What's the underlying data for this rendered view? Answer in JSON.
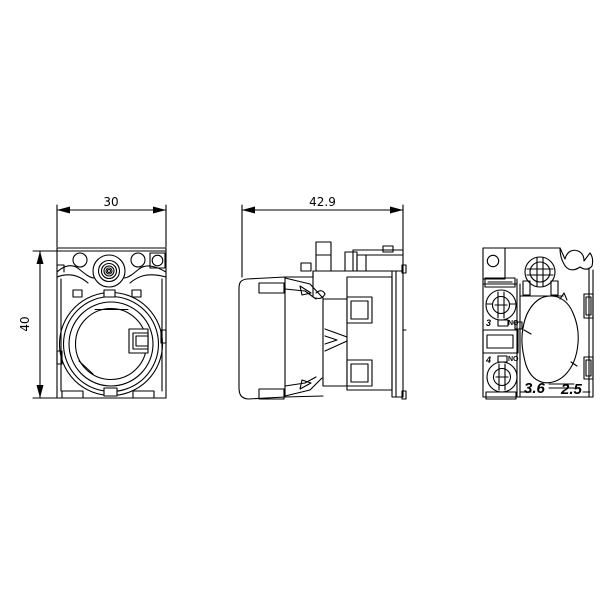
{
  "background_color": "#ffffff",
  "line_color": "#000000",
  "views": {
    "front": {
      "width_dim": "30",
      "height_dim": "40"
    },
    "side": {
      "depth_dim": "42.9"
    },
    "rear": {
      "terminal_top_number": "3",
      "terminal_top_type": "NO",
      "terminal_bottom_number": "4",
      "terminal_bottom_type": "NO",
      "mold_text_left": "3.6",
      "mold_text_right": "2.5"
    }
  }
}
